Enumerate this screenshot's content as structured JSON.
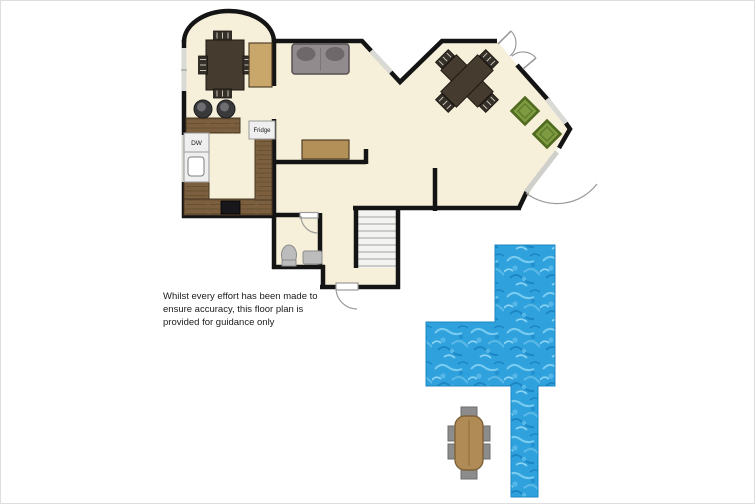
{
  "labels": {
    "dw": "DW",
    "fridge": "Fridge"
  },
  "disclaimer": {
    "line1": "Whilst every effort has been made to",
    "line2": "ensure accuracy, this floor plan is",
    "line3": "provided for guidance only"
  },
  "icons": {
    "dining_table": "dark cross dining table with chairs",
    "sofa": "gray two-seat sofa",
    "armchair": "green armchair",
    "stool": "bar stool",
    "toilet": "toilet",
    "basin": "hand basin",
    "stairs": "staircase",
    "swimming_pool": "outdoor swimming pool",
    "outdoor_table": "garden dining table with six chairs"
  },
  "colors": {
    "floor": "#f6efd9",
    "wall": "#141414",
    "wood": "#7b5f3e",
    "wood_dark": "#685033",
    "table": "#453b2e",
    "cabinet": "#c9a76b",
    "sideboard": "#b29057",
    "sofa": "#918b8e",
    "sofa_dark": "#6f686b",
    "green_chair": "#7e9b41",
    "green_chair_border": "#4f6a1e",
    "pool": "#2fa2de",
    "pool_light": "#79cbf0",
    "pool_dark": "#1d87c4",
    "fixture": "#bcbcbc",
    "appliance": "#efefef",
    "stove": "#17171c",
    "stool": "#39393b",
    "window": "#d9d9d6",
    "door_arc": "#9b9b9b",
    "stairs": "#f3f3f1",
    "outdoor_table": "#b08b55",
    "outdoor_chair": "#8c8c8c"
  }
}
